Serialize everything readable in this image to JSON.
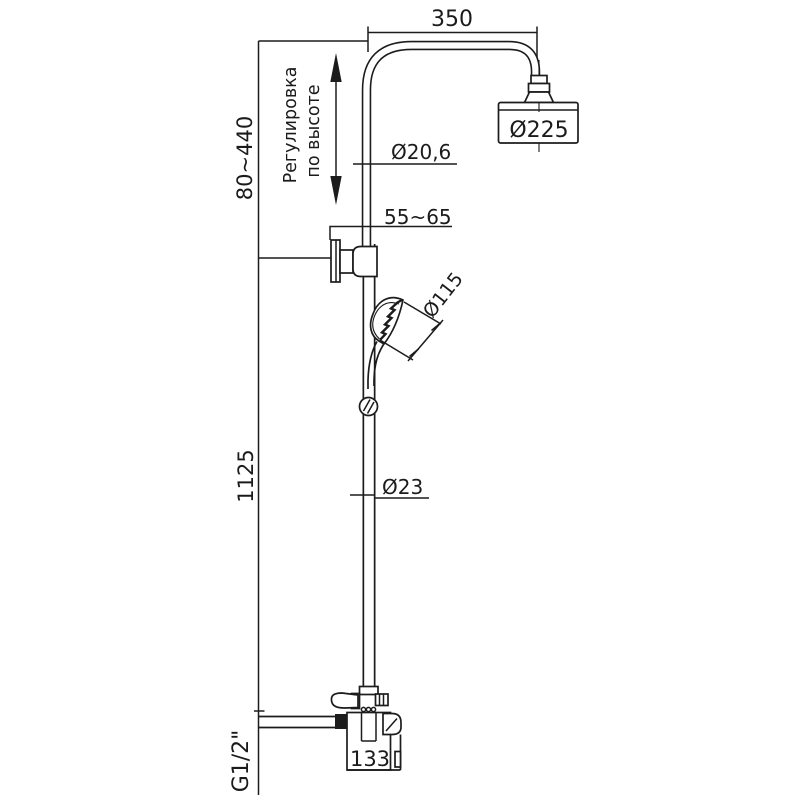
{
  "drawing": {
    "type": "technical-dimension-drawing",
    "subject": "shower column with overhead rain shower, hand shower and wall mixer",
    "colors": {
      "line": "#1c1c1c",
      "background": "#ffffff"
    },
    "labels": {
      "arm_width": "350",
      "height_adjust_range": "80~440",
      "adjust_note_line1": "Регулировка",
      "adjust_note_line2": "по высоте",
      "upper_pipe_diameter": "Ø20,6",
      "bracket_depth_range": "55~65",
      "overhead_diameter": "Ø225",
      "hand_shower_diameter": "Ø115",
      "column_height": "1125",
      "lower_pipe_diameter": "Ø23",
      "mixer_width": "133",
      "thread_size": "G1/2\""
    }
  }
}
